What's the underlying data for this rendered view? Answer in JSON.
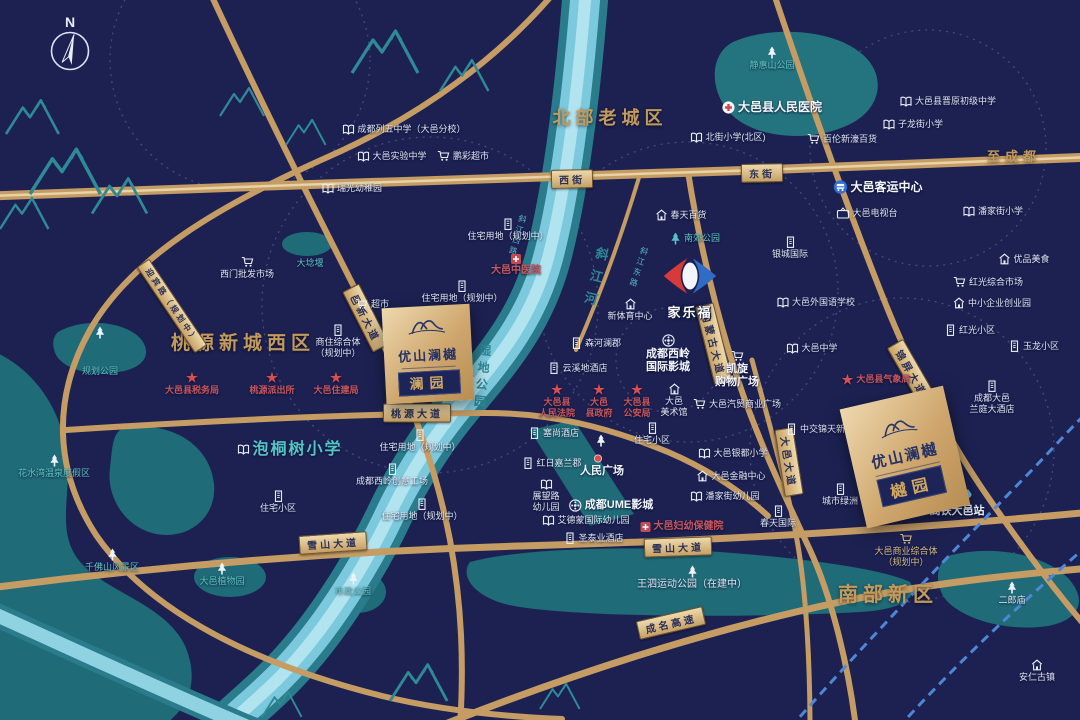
{
  "map": {
    "compass_label": "N",
    "landmarks": {
      "carrefour_label": "家乐福"
    },
    "districts": [
      {
        "label": "北部老城区",
        "x": 610,
        "y": 104,
        "fs": 18
      },
      {
        "label": "桃源新城西区",
        "x": 243,
        "y": 328,
        "fs": 19
      },
      {
        "label": "南部新区",
        "x": 888,
        "y": 578,
        "fs": 20
      },
      {
        "label": "至成都",
        "x": 1014,
        "y": 146,
        "fs": 13
      }
    ],
    "properties": [
      {
        "name": "优山澜樾",
        "badge": "澜园",
        "x": 384,
        "y": 306,
        "w": 88,
        "h": 96,
        "rot": -3,
        "nfs": 13,
        "bfs": 14
      },
      {
        "name": "优山澜樾",
        "badge": "樾园",
        "x": 852,
        "y": 396,
        "w": 106,
        "h": 122,
        "rot": -13,
        "nfs": 15,
        "bfs": 16
      }
    ],
    "road_labels": [
      {
        "t": "西街",
        "x": 572,
        "y": 179,
        "rot": -1
      },
      {
        "t": "东街",
        "x": 762,
        "y": 173,
        "rot": -1
      },
      {
        "t": "桃源大道",
        "x": 417,
        "y": 413,
        "rot": 0
      },
      {
        "t": "雪山大道",
        "x": 333,
        "y": 543,
        "rot": -4
      },
      {
        "t": "雪山大道",
        "x": 678,
        "y": 547,
        "rot": -2
      },
      {
        "t": "成名高速",
        "x": 671,
        "y": 623,
        "rot": -13
      },
      {
        "t": "邑新大道",
        "x": 366,
        "y": 318,
        "rot": 63
      },
      {
        "t": "内蒙古大道",
        "x": 714,
        "y": 344,
        "rot": 76
      },
      {
        "t": "锦屏大道",
        "x": 912,
        "y": 373,
        "rot": 60
      },
      {
        "t": "大邑大道",
        "x": 789,
        "y": 462,
        "rot": 81
      },
      {
        "t": "迎宾路（规划中）",
        "x": 172,
        "y": 306,
        "rot": 56,
        "fs": 8
      }
    ],
    "river_labels": [
      {
        "t": "斜江河",
        "x": 585,
        "y": 246,
        "rot": 14,
        "fs": 13,
        "ls": 10
      },
      {
        "t": "湿地公园",
        "x": 474,
        "y": 344,
        "rot": 6,
        "fs": 12,
        "ls": 5
      },
      {
        "t": "斜江西路",
        "x": 512,
        "y": 214,
        "rot": 16,
        "fs": 8,
        "ls": 3,
        "c": "lt"
      },
      {
        "t": "斜江东路",
        "x": 633,
        "y": 246,
        "rot": 18,
        "fs": 8,
        "ls": 3,
        "c": "lt"
      }
    ],
    "pois": [
      {
        "t": "成都列五中学（大邑分校）",
        "x": 404,
        "y": 124,
        "ic": "book",
        "l": "r"
      },
      {
        "t": "大邑实验中学",
        "x": 392,
        "y": 151,
        "ic": "book",
        "l": "r"
      },
      {
        "t": "瑞光幼稚园",
        "x": 352,
        "y": 183,
        "ic": "book",
        "l": "r"
      },
      {
        "t": "鹏彩超市",
        "x": 463,
        "y": 150,
        "ic": "cart",
        "l": "r"
      },
      {
        "t": "静惠山公园",
        "x": 772,
        "y": 46,
        "ic": "treew",
        "l": "c",
        "c": "t"
      },
      {
        "t": "大邑县人民医院",
        "x": 772,
        "y": 100,
        "ic": "cross",
        "l": "r",
        "c": "wb",
        "fs": 12
      },
      {
        "t": "北街小学(北区)",
        "x": 728,
        "y": 132,
        "ic": "book",
        "l": "r"
      },
      {
        "t": "百伦新濠百货",
        "x": 842,
        "y": 133,
        "ic": "cart",
        "l": "r"
      },
      {
        "t": "大邑县晋原初级中学",
        "x": 948,
        "y": 96,
        "ic": "book",
        "l": "r"
      },
      {
        "t": "子龙街小学",
        "x": 913,
        "y": 119,
        "ic": "book",
        "l": "r"
      },
      {
        "t": "潘家街小学",
        "x": 993,
        "y": 206,
        "ic": "book",
        "l": "r"
      },
      {
        "t": "大邑客运中心",
        "x": 878,
        "y": 180,
        "ic": "bus",
        "l": "r",
        "c": "wb",
        "fs": 12
      },
      {
        "t": "大邑电视台",
        "x": 867,
        "y": 207,
        "ic": "tv",
        "l": "r"
      },
      {
        "t": "春天百货",
        "x": 681,
        "y": 209,
        "ic": "home",
        "l": "r"
      },
      {
        "t": "南郊公园",
        "x": 695,
        "y": 232,
        "ic": "treet",
        "l": "r",
        "c": "t"
      },
      {
        "t": "大埝堰",
        "x": 310,
        "y": 258,
        "c": "t"
      },
      {
        "t": "住宅用地（规划中）",
        "x": 508,
        "y": 218,
        "ic": "bld",
        "l": "c"
      },
      {
        "t": "大邑中医院",
        "x": 516,
        "y": 254,
        "ic": "crossr",
        "l": "c",
        "c": "r",
        "fs": 10
      },
      {
        "t": "住宅用地（规划中）",
        "x": 462,
        "y": 280,
        "ic": "bld",
        "l": "c"
      },
      {
        "t": "超市",
        "x": 372,
        "y": 298,
        "ic": "cart",
        "l": "r"
      },
      {
        "t": "西门批发市场",
        "x": 247,
        "y": 256,
        "ic": "cart",
        "l": "c"
      },
      {
        "t": "商住综合体\n（规划中）",
        "x": 338,
        "y": 324,
        "ic": "bld",
        "l": "c"
      },
      {
        "t": "大邑县税务局",
        "x": 192,
        "y": 371,
        "ic": "star",
        "l": "c",
        "c": "r"
      },
      {
        "t": "桃源派出所",
        "x": 272,
        "y": 371,
        "ic": "star",
        "l": "c",
        "c": "r"
      },
      {
        "t": "大邑住建局",
        "x": 336,
        "y": 371,
        "ic": "star",
        "l": "c",
        "c": "r"
      },
      {
        "t": "泡桐树小学",
        "x": 290,
        "y": 440,
        "ic": "book",
        "l": "r",
        "c": "tb",
        "fs": 16
      },
      {
        "t": "",
        "x": 100,
        "y": 326,
        "ic": "treew"
      },
      {
        "t": "规划公园",
        "x": 100,
        "y": 366,
        "c": "t"
      },
      {
        "t": "花水湾温泉度假区",
        "x": 54,
        "y": 454,
        "ic": "treew",
        "l": "c",
        "c": "t"
      },
      {
        "t": "千佛山风景区",
        "x": 112,
        "y": 548,
        "ic": "treew",
        "l": "c",
        "c": "t"
      },
      {
        "t": "大邑植物园",
        "x": 222,
        "y": 562,
        "ic": "treew",
        "l": "c",
        "c": "t"
      },
      {
        "t": "市政公园",
        "x": 353,
        "y": 572,
        "ic": "treew",
        "l": "c",
        "c": "t"
      },
      {
        "t": "银城国际",
        "x": 790,
        "y": 236,
        "ic": "bld",
        "l": "c"
      },
      {
        "t": "新体育中心",
        "x": 630,
        "y": 298,
        "ic": "home",
        "l": "c"
      },
      {
        "t": "大邑外国语学校",
        "x": 816,
        "y": 297,
        "ic": "book",
        "l": "r"
      },
      {
        "t": "大邑中学",
        "x": 812,
        "y": 343,
        "ic": "book",
        "l": "r"
      },
      {
        "t": "森河澜郡",
        "x": 596,
        "y": 337,
        "ic": "bld",
        "l": "r"
      },
      {
        "t": "云溪地酒店",
        "x": 578,
        "y": 362,
        "ic": "bld",
        "l": "r"
      },
      {
        "t": "成都西岭\n国际影城",
        "x": 668,
        "y": 334,
        "ic": "film",
        "l": "c",
        "c": "wb",
        "fs": 11
      },
      {
        "t": "凯旋\n购物广场",
        "x": 737,
        "y": 350,
        "ic": "cart",
        "l": "c",
        "c": "wb",
        "fs": 11
      },
      {
        "t": "大邑县气象局",
        "x": 876,
        "y": 373,
        "ic": "star",
        "l": "r",
        "c": "r"
      },
      {
        "t": "红光综合市场",
        "x": 988,
        "y": 276,
        "ic": "cart",
        "l": "r"
      },
      {
        "t": "优品美食",
        "x": 1024,
        "y": 253,
        "ic": "home",
        "l": "r"
      },
      {
        "t": "中小企业创业园",
        "x": 992,
        "y": 297,
        "ic": "home",
        "l": "r"
      },
      {
        "t": "红光小区",
        "x": 970,
        "y": 324,
        "ic": "bld",
        "l": "r"
      },
      {
        "t": "玉龙小区",
        "x": 1034,
        "y": 340,
        "ic": "bld",
        "l": "r"
      },
      {
        "t": "大邑县\n人民法院",
        "x": 557,
        "y": 383,
        "ic": "star",
        "l": "c",
        "c": "r"
      },
      {
        "t": "大邑\n县政府",
        "x": 599,
        "y": 383,
        "ic": "star",
        "l": "c",
        "c": "r"
      },
      {
        "t": "大邑县\n公安局",
        "x": 637,
        "y": 383,
        "ic": "star",
        "l": "c",
        "c": "r"
      },
      {
        "t": "大邑\n美术馆",
        "x": 674,
        "y": 383,
        "ic": "home",
        "l": "c"
      },
      {
        "t": "大邑汽贸商业广场",
        "x": 737,
        "y": 398,
        "ic": "cart",
        "l": "r"
      },
      {
        "t": "中交锦天新城",
        "x": 820,
        "y": 423,
        "ic": "bld",
        "l": "r"
      },
      {
        "t": "住宅小区",
        "x": 652,
        "y": 422,
        "ic": "bld",
        "l": "c"
      },
      {
        "t": "住宅用地（规划中）",
        "x": 420,
        "y": 429,
        "ic": "bld",
        "l": "c"
      },
      {
        "t": "成都西岭创意工场",
        "x": 392,
        "y": 463,
        "ic": "bld",
        "l": "c"
      },
      {
        "t": "住宅用地（规划中）",
        "x": 422,
        "y": 498,
        "ic": "bld",
        "l": "c"
      },
      {
        "t": "住宅小区",
        "x": 278,
        "y": 490,
        "ic": "bld",
        "l": "c"
      },
      {
        "t": "塞尚酒店",
        "x": 554,
        "y": 427,
        "ic": "bld",
        "l": "r"
      },
      {
        "t": "红日嘉兰郡",
        "x": 552,
        "y": 457,
        "ic": "bld",
        "l": "r"
      },
      {
        "t": "展望路\n幼儿园",
        "x": 546,
        "y": 479,
        "ic": "book",
        "l": "c"
      },
      {
        "t": "",
        "x": 601,
        "y": 434,
        "ic": "treew"
      },
      {
        "t": "",
        "x": 598,
        "y": 454,
        "ic": "dot"
      },
      {
        "t": "人民广场",
        "x": 602,
        "y": 465,
        "c": "wb",
        "fs": 11
      },
      {
        "t": "成都UME影城",
        "x": 611,
        "y": 499,
        "ic": "film",
        "l": "r",
        "c": "wb",
        "fs": 11
      },
      {
        "t": "艾德蒙国际幼儿园",
        "x": 586,
        "y": 515,
        "ic": "book",
        "l": "r"
      },
      {
        "t": "圣泰业酒店",
        "x": 594,
        "y": 532,
        "ic": "bld",
        "l": "r"
      },
      {
        "t": "大邑妇幼保健院",
        "x": 682,
        "y": 521,
        "ic": "crossr",
        "l": "r",
        "c": "r",
        "fs": 10
      },
      {
        "t": "大邑银都小学",
        "x": 733,
        "y": 448,
        "ic": "book",
        "l": "r"
      },
      {
        "t": "大邑金融中心",
        "x": 731,
        "y": 470,
        "ic": "home",
        "l": "r"
      },
      {
        "t": "潘家街幼儿园",
        "x": 725,
        "y": 491,
        "ic": "book",
        "l": "r"
      },
      {
        "t": "春天国际",
        "x": 778,
        "y": 505,
        "ic": "bld",
        "l": "c"
      },
      {
        "t": "城市绿洲",
        "x": 840,
        "y": 483,
        "ic": "bld",
        "l": "c"
      },
      {
        "t": "大邑商业综合体\n（规划中）",
        "x": 906,
        "y": 533,
        "ic": "cartg",
        "l": "c",
        "c": "gd"
      },
      {
        "t": "高铁大邑站",
        "x": 957,
        "y": 488,
        "ic": "train",
        "l": "c",
        "c": "wb",
        "fs": 11
      },
      {
        "t": "成都大邑\n兰庭大酒店",
        "x": 992,
        "y": 380,
        "ic": "bld",
        "l": "c"
      },
      {
        "t": "王泗运动公园（在建中）",
        "x": 692,
        "y": 565,
        "ic": "treew",
        "l": "c",
        "fs": 10
      },
      {
        "t": "二郎庙",
        "x": 1012,
        "y": 581,
        "ic": "treew",
        "l": "c"
      },
      {
        "t": "安仁古镇",
        "x": 1037,
        "y": 659,
        "ic": "home",
        "l": "c"
      }
    ]
  }
}
